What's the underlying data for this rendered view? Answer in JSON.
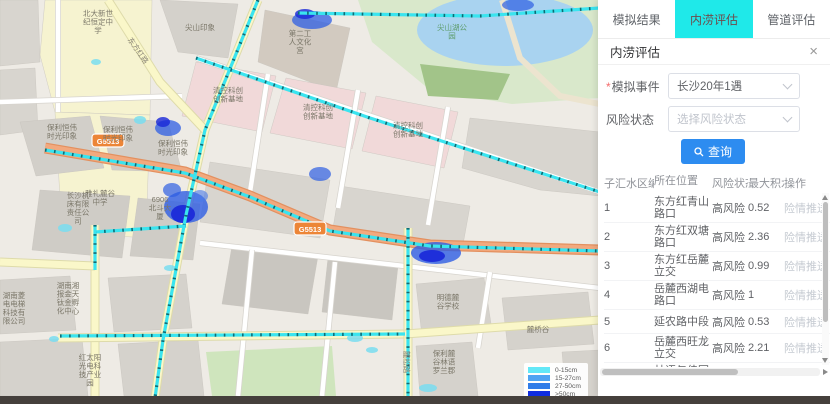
{
  "tabs": [
    {
      "id": "simulation-results",
      "label": "模拟结果",
      "active": false
    },
    {
      "id": "waterlogging-assessment",
      "label": "内涝评估",
      "active": true
    },
    {
      "id": "pipeline-assessment",
      "label": "管道评估",
      "active": false
    }
  ],
  "panel": {
    "title": "内涝评估",
    "close_icon": "×",
    "form": {
      "event_required_mark": "*",
      "event_label": "模拟事件",
      "event_value": "长沙20年1遇",
      "risk_label": "风险状态",
      "risk_placeholder": "选择风险状态",
      "search_button": "查询",
      "search_icon": "magnifier"
    },
    "table": {
      "headers": [
        "子汇水区编号",
        "所在位置",
        "风险状态",
        "最大积水深",
        "操作"
      ],
      "rows": [
        {
          "id": "1",
          "location": "东方红青山路口",
          "risk": "高风险",
          "depth": "0.52",
          "action": "险情推送"
        },
        {
          "id": "2",
          "location": "东方红双塘路口",
          "risk": "高风险",
          "depth": "2.36",
          "action": "险情推送"
        },
        {
          "id": "3",
          "location": "东方红岳麓立交",
          "risk": "高风险",
          "depth": "0.99",
          "action": "险情推送"
        },
        {
          "id": "4",
          "location": "岳麓西湖电路口",
          "risk": "高风险",
          "depth": "1",
          "action": "险情推送"
        },
        {
          "id": "5",
          "location": "延农路中段",
          "risk": "高风险",
          "depth": "0.53",
          "action": "险情推送"
        },
        {
          "id": "6",
          "location": "岳麓西旺龙立交",
          "risk": "高风险",
          "depth": "2.21",
          "action": "险情推送"
        },
        {
          "id": "7",
          "location": "林语与佳园路",
          "risk": "中风险",
          "depth": "0.26",
          "action": "险情推送"
        },
        {
          "id": "8",
          "location": "东方红桐梓坡路口",
          "risk": "高风险",
          "depth": "0.34",
          "action": "险情推送"
        }
      ]
    }
  },
  "map": {
    "base": "#eeebe5",
    "colors": {
      "pipe": "#3ae4ef",
      "pipe_dot": "#0e6b74",
      "highway": "#f2a97e",
      "highway_edge": "#e3905f",
      "road_yellow": "#faf7c9",
      "road_yellow_edge": "#dedbaa",
      "road_white": "#ffffff",
      "road_white_edge": "#d7d4ce",
      "park": "#d9e8cb",
      "water": "#a9d3f0",
      "forest": "#a2c489",
      "green2": "#cfe5bd",
      "cream": "#ece4cf"
    },
    "park": "358,0 600,0 600,98 512,104 430,90 372,42",
    "lake": {
      "cx": 505,
      "cy": 30,
      "rx": 88,
      "ry": 36
    },
    "forest": "420,64 510,74 498,100 428,96",
    "green2": "206,352 332,346 336,396 212,396",
    "blocks": [
      {
        "f": "#f6f3d0",
        "p": "45,0 152,0 150,115 55,112 40,55"
      },
      {
        "f": "#f6f3d0",
        "p": "55,112 150,115 146,238 62,232"
      },
      {
        "f": "#d8d5cf",
        "p": "0,0 38,0 40,62 0,66"
      },
      {
        "f": "#d8d5cf",
        "p": "0,70 35,68 38,130 0,135"
      },
      {
        "f": "#d4d1cb",
        "p": "160,0 238,4 228,58 178,52"
      },
      {
        "f": "#d2cac0",
        "p": "265,10 350,28 336,92 258,62"
      },
      {
        "f": "#f1d9d9",
        "p": "196,62 276,76 262,132 182,116"
      },
      {
        "f": "#f1d9d9",
        "p": "286,78 366,93 352,149 270,133"
      },
      {
        "f": "#f1d9d9",
        "p": "376,96 458,112 444,168 362,151"
      },
      {
        "f": "#d8d5cf",
        "p": "470,118 600,132 600,196 540,190 462,168"
      },
      {
        "f": "#d2cfc9",
        "p": "20,122 90,116 104,168 36,176"
      },
      {
        "f": "#d2cfc9",
        "p": "100,116 168,122 182,172 112,170"
      },
      {
        "f": "#cfccc6",
        "p": "40,190 130,196 122,258 32,250"
      },
      {
        "f": "#cfccc6",
        "p": "138,198 200,204 193,260 130,256"
      },
      {
        "f": "#d8d5cf",
        "p": "210,162 330,180 320,238 200,222"
      },
      {
        "f": "#d8d5cf",
        "p": "340,186 470,206 462,250 332,234"
      },
      {
        "f": "#d5d2cc",
        "p": "0,280 70,276 76,330 0,334"
      },
      {
        "f": "#d5d2cc",
        "p": "0,342 82,338 88,396 0,396"
      },
      {
        "f": "#d5d2cc",
        "p": "108,278 186,274 192,328 114,332"
      },
      {
        "f": "#d5d2cc",
        "p": "118,344 198,340 204,396 124,396"
      },
      {
        "f": "#c9c6c0",
        "p": "232,246 318,256 308,314 222,304"
      },
      {
        "f": "#c9c6c0",
        "p": "328,258 398,266 392,320 322,312"
      },
      {
        "f": "#d5d2cc",
        "p": "416,284 484,278 492,330 422,336"
      },
      {
        "f": "#d5d2cc",
        "p": "502,298 588,292 594,344 508,350"
      },
      {
        "f": "#d5d2cc",
        "p": "416,346 472,342 478,396 420,396"
      },
      {
        "f": "#d5d2cc",
        "p": "562,352 600,350 600,396 566,396"
      }
    ],
    "white_roads": [
      "M58,0 L58,112",
      "M0,102 L182,96",
      "M196,58 L600,192",
      "M268,74 L250,192",
      "M358,90 L338,208",
      "M448,107 L428,225",
      "M200,243 L600,288",
      "M252,250 L238,396",
      "M335,262 L322,396",
      "M490,272 L478,348"
    ],
    "yellow_roads": [
      "M258,0 L205,130 L186,215 L163,340 L155,398",
      "M108,0 L160,82 L205,130",
      "M95,225 L95,398",
      "M0,262 L95,266",
      "M58,338 L405,334",
      "M408,228 L408,398",
      "M405,334 L600,320"
    ],
    "cream_road": "M502,0 L520,58 L560,96 L600,104",
    "highway_path": "M45,148 L185,172 L250,196 L330,230 L430,245 L600,250",
    "pipes": [
      "M45,150 L185,173 L250,197 L330,231 L430,246 L600,251",
      "M258,0 L205,130 L186,215 L163,340 L155,398",
      "M298,13 L480,16 L600,8",
      "M196,58 L370,118 L600,192",
      "M60,336 L405,334",
      "M408,228 L408,398",
      "M95,232 L186,226",
      "M95,225 L95,270"
    ],
    "blobs": [
      {
        "x": 186,
        "y": 207,
        "rx": 22,
        "ry": 16,
        "f": "#2e5ee3",
        "o": 0.8
      },
      {
        "x": 183,
        "y": 214,
        "rx": 12,
        "ry": 9,
        "f": "#1827d8",
        "o": 0.9
      },
      {
        "x": 172,
        "y": 190,
        "rx": 9,
        "ry": 7,
        "f": "#2e5ee3",
        "o": 0.7
      },
      {
        "x": 200,
        "y": 196,
        "rx": 8,
        "ry": 6,
        "f": "#4a7ae8",
        "o": 0.6
      },
      {
        "x": 436,
        "y": 253,
        "rx": 25,
        "ry": 11,
        "f": "#2e5ee3",
        "o": 0.8
      },
      {
        "x": 432,
        "y": 256,
        "rx": 13,
        "ry": 6,
        "f": "#1827d8",
        "o": 0.9
      },
      {
        "x": 312,
        "y": 20,
        "rx": 20,
        "ry": 9,
        "f": "#2e5ee3",
        "o": 0.75
      },
      {
        "x": 305,
        "y": 14,
        "rx": 10,
        "ry": 5,
        "f": "#1827d8",
        "o": 0.8
      },
      {
        "x": 518,
        "y": 5,
        "rx": 16,
        "ry": 6,
        "f": "#2e5ee3",
        "o": 0.7
      },
      {
        "x": 320,
        "y": 174,
        "rx": 11,
        "ry": 7,
        "f": "#2e5ee3",
        "o": 0.7
      },
      {
        "x": 168,
        "y": 128,
        "rx": 13,
        "ry": 8,
        "f": "#2e5ee3",
        "o": 0.75
      },
      {
        "x": 163,
        "y": 122,
        "rx": 7,
        "ry": 5,
        "f": "#1827d8",
        "o": 0.8
      },
      {
        "x": 140,
        "y": 120,
        "rx": 6,
        "ry": 4,
        "f": "#79ddf0",
        "o": 0.85
      },
      {
        "x": 65,
        "y": 228,
        "rx": 7,
        "ry": 4,
        "f": "#79ddf0",
        "o": 0.85
      },
      {
        "x": 355,
        "y": 338,
        "rx": 8,
        "ry": 4,
        "f": "#79ddf0",
        "o": 0.85
      },
      {
        "x": 372,
        "y": 350,
        "rx": 6,
        "ry": 3,
        "f": "#79ddf0",
        "o": 0.85
      },
      {
        "x": 428,
        "y": 388,
        "rx": 9,
        "ry": 4,
        "f": "#79ddf0",
        "o": 0.85
      },
      {
        "x": 54,
        "y": 339,
        "rx": 5,
        "ry": 3,
        "f": "#79ddf0",
        "o": 0.85
      },
      {
        "x": 96,
        "y": 62,
        "rx": 5,
        "ry": 3,
        "f": "#79ddf0",
        "o": 0.85
      },
      {
        "x": 170,
        "y": 268,
        "rx": 6,
        "ry": 3,
        "f": "#79ddf0",
        "o": 0.85
      }
    ],
    "badges": [
      {
        "text": "G5513",
        "x": 108,
        "y": 141
      },
      {
        "text": "G5513",
        "x": 310,
        "y": 229
      }
    ],
    "labels": [
      {
        "lines": [
          "北大新世",
          "纪恒定中",
          "学"
        ],
        "x": 98,
        "y": 16
      },
      {
        "lines": [
          "雅礼麓谷",
          "中学"
        ],
        "x": 100,
        "y": 196
      },
      {
        "lines": [
          "尖山印象"
        ],
        "x": 200,
        "y": 30
      },
      {
        "lines": [
          "第二工",
          "人文化",
          "宫"
        ],
        "x": 300,
        "y": 36
      },
      {
        "lines": [
          "尖山湖公",
          "园"
        ],
        "x": 452,
        "y": 30,
        "c": "#5f9e6e"
      },
      {
        "lines": [
          "清控科创",
          "创新基地"
        ],
        "x": 228,
        "y": 93
      },
      {
        "lines": [
          "清控科创",
          "创新基地"
        ],
        "x": 318,
        "y": 110
      },
      {
        "lines": [
          "清控科创",
          "创新基地"
        ],
        "x": 408,
        "y": 128
      },
      {
        "lines": [
          "保利恒伟",
          "时光印象"
        ],
        "x": 62,
        "y": 130
      },
      {
        "lines": [
          "保利恒伟",
          "时光印象"
        ],
        "x": 118,
        "y": 132
      },
      {
        "lines": [
          "保利恒伟",
          "时光印象"
        ],
        "x": 173,
        "y": 146
      },
      {
        "lines": [
          "长沙机",
          "床有限",
          "责任公",
          "司"
        ],
        "x": 78,
        "y": 198
      },
      {
        "lines": [
          "6906",
          "北斗大",
          "厦"
        ],
        "x": 160,
        "y": 202
      },
      {
        "lines": [
          "明德麓",
          "谷学校"
        ],
        "x": 448,
        "y": 300
      },
      {
        "lines": [
          "麓桥谷"
        ],
        "x": 538,
        "y": 332
      },
      {
        "lines": [
          "保利麓",
          "谷林语",
          "罗兰郡"
        ],
        "x": 444,
        "y": 356
      },
      {
        "lines": [
          "红太阳",
          "光电科",
          "技产业",
          "园"
        ],
        "x": 90,
        "y": 360
      },
      {
        "lines": [
          "湖南菱",
          "电电梯",
          "科技有",
          "限公司"
        ],
        "x": 14,
        "y": 298
      },
      {
        "lines": [
          "湖南湘",
          "报金天",
          "钛金孵",
          "化中心"
        ],
        "x": 68,
        "y": 288
      },
      {
        "lines": [
          "麓松路"
        ],
        "x": 404,
        "y": 362,
        "rot": 90,
        "c": "#8a8578"
      },
      {
        "lines": [
          "东方红路"
        ],
        "x": 136,
        "y": 52,
        "rot": 55,
        "c": "#8a8578"
      }
    ],
    "legend": {
      "items": [
        {
          "label": "0-15cm",
          "color": "#63e8f7"
        },
        {
          "label": "15-27cm",
          "color": "#4fa3f2"
        },
        {
          "label": "27-50cm",
          "color": "#2f7ce8"
        },
        {
          "label": ">50cm",
          "color": "#0f2ce0"
        }
      ]
    }
  }
}
